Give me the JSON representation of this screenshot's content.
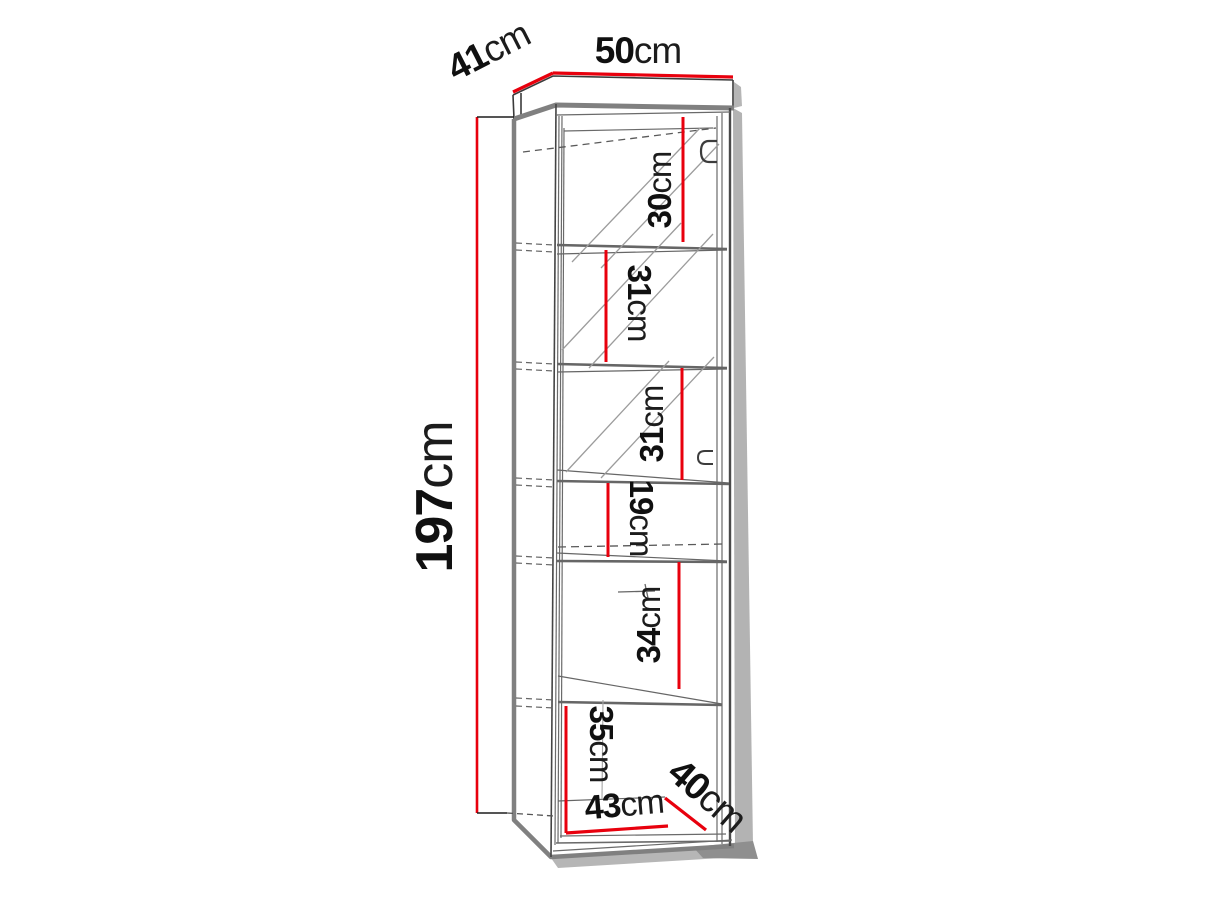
{
  "figure": {
    "title": "cabinet-dimension-diagram",
    "subject": "tall one-door display cabinet with five shelves, drawn in perspective with red dimension lines",
    "unit": "cm",
    "accent_color": "#e8000d",
    "outline_color": "#808080",
    "dimensions": {
      "top_width": {
        "value": "50",
        "unit": "cm"
      },
      "top_depth": {
        "value": "41",
        "unit": "cm"
      },
      "height": {
        "value": "197",
        "unit": "cm"
      },
      "compartments": [
        {
          "value": "30",
          "unit": "cm"
        },
        {
          "value": "31",
          "unit": "cm"
        },
        {
          "value": "31",
          "unit": "cm"
        },
        {
          "value": "19",
          "unit": "cm"
        },
        {
          "value": "34",
          "unit": "cm"
        },
        {
          "value": "35",
          "unit": "cm"
        }
      ],
      "interior_width": {
        "value": "43",
        "unit": "cm"
      },
      "interior_depth": {
        "value": "40",
        "unit": "cm"
      }
    }
  }
}
